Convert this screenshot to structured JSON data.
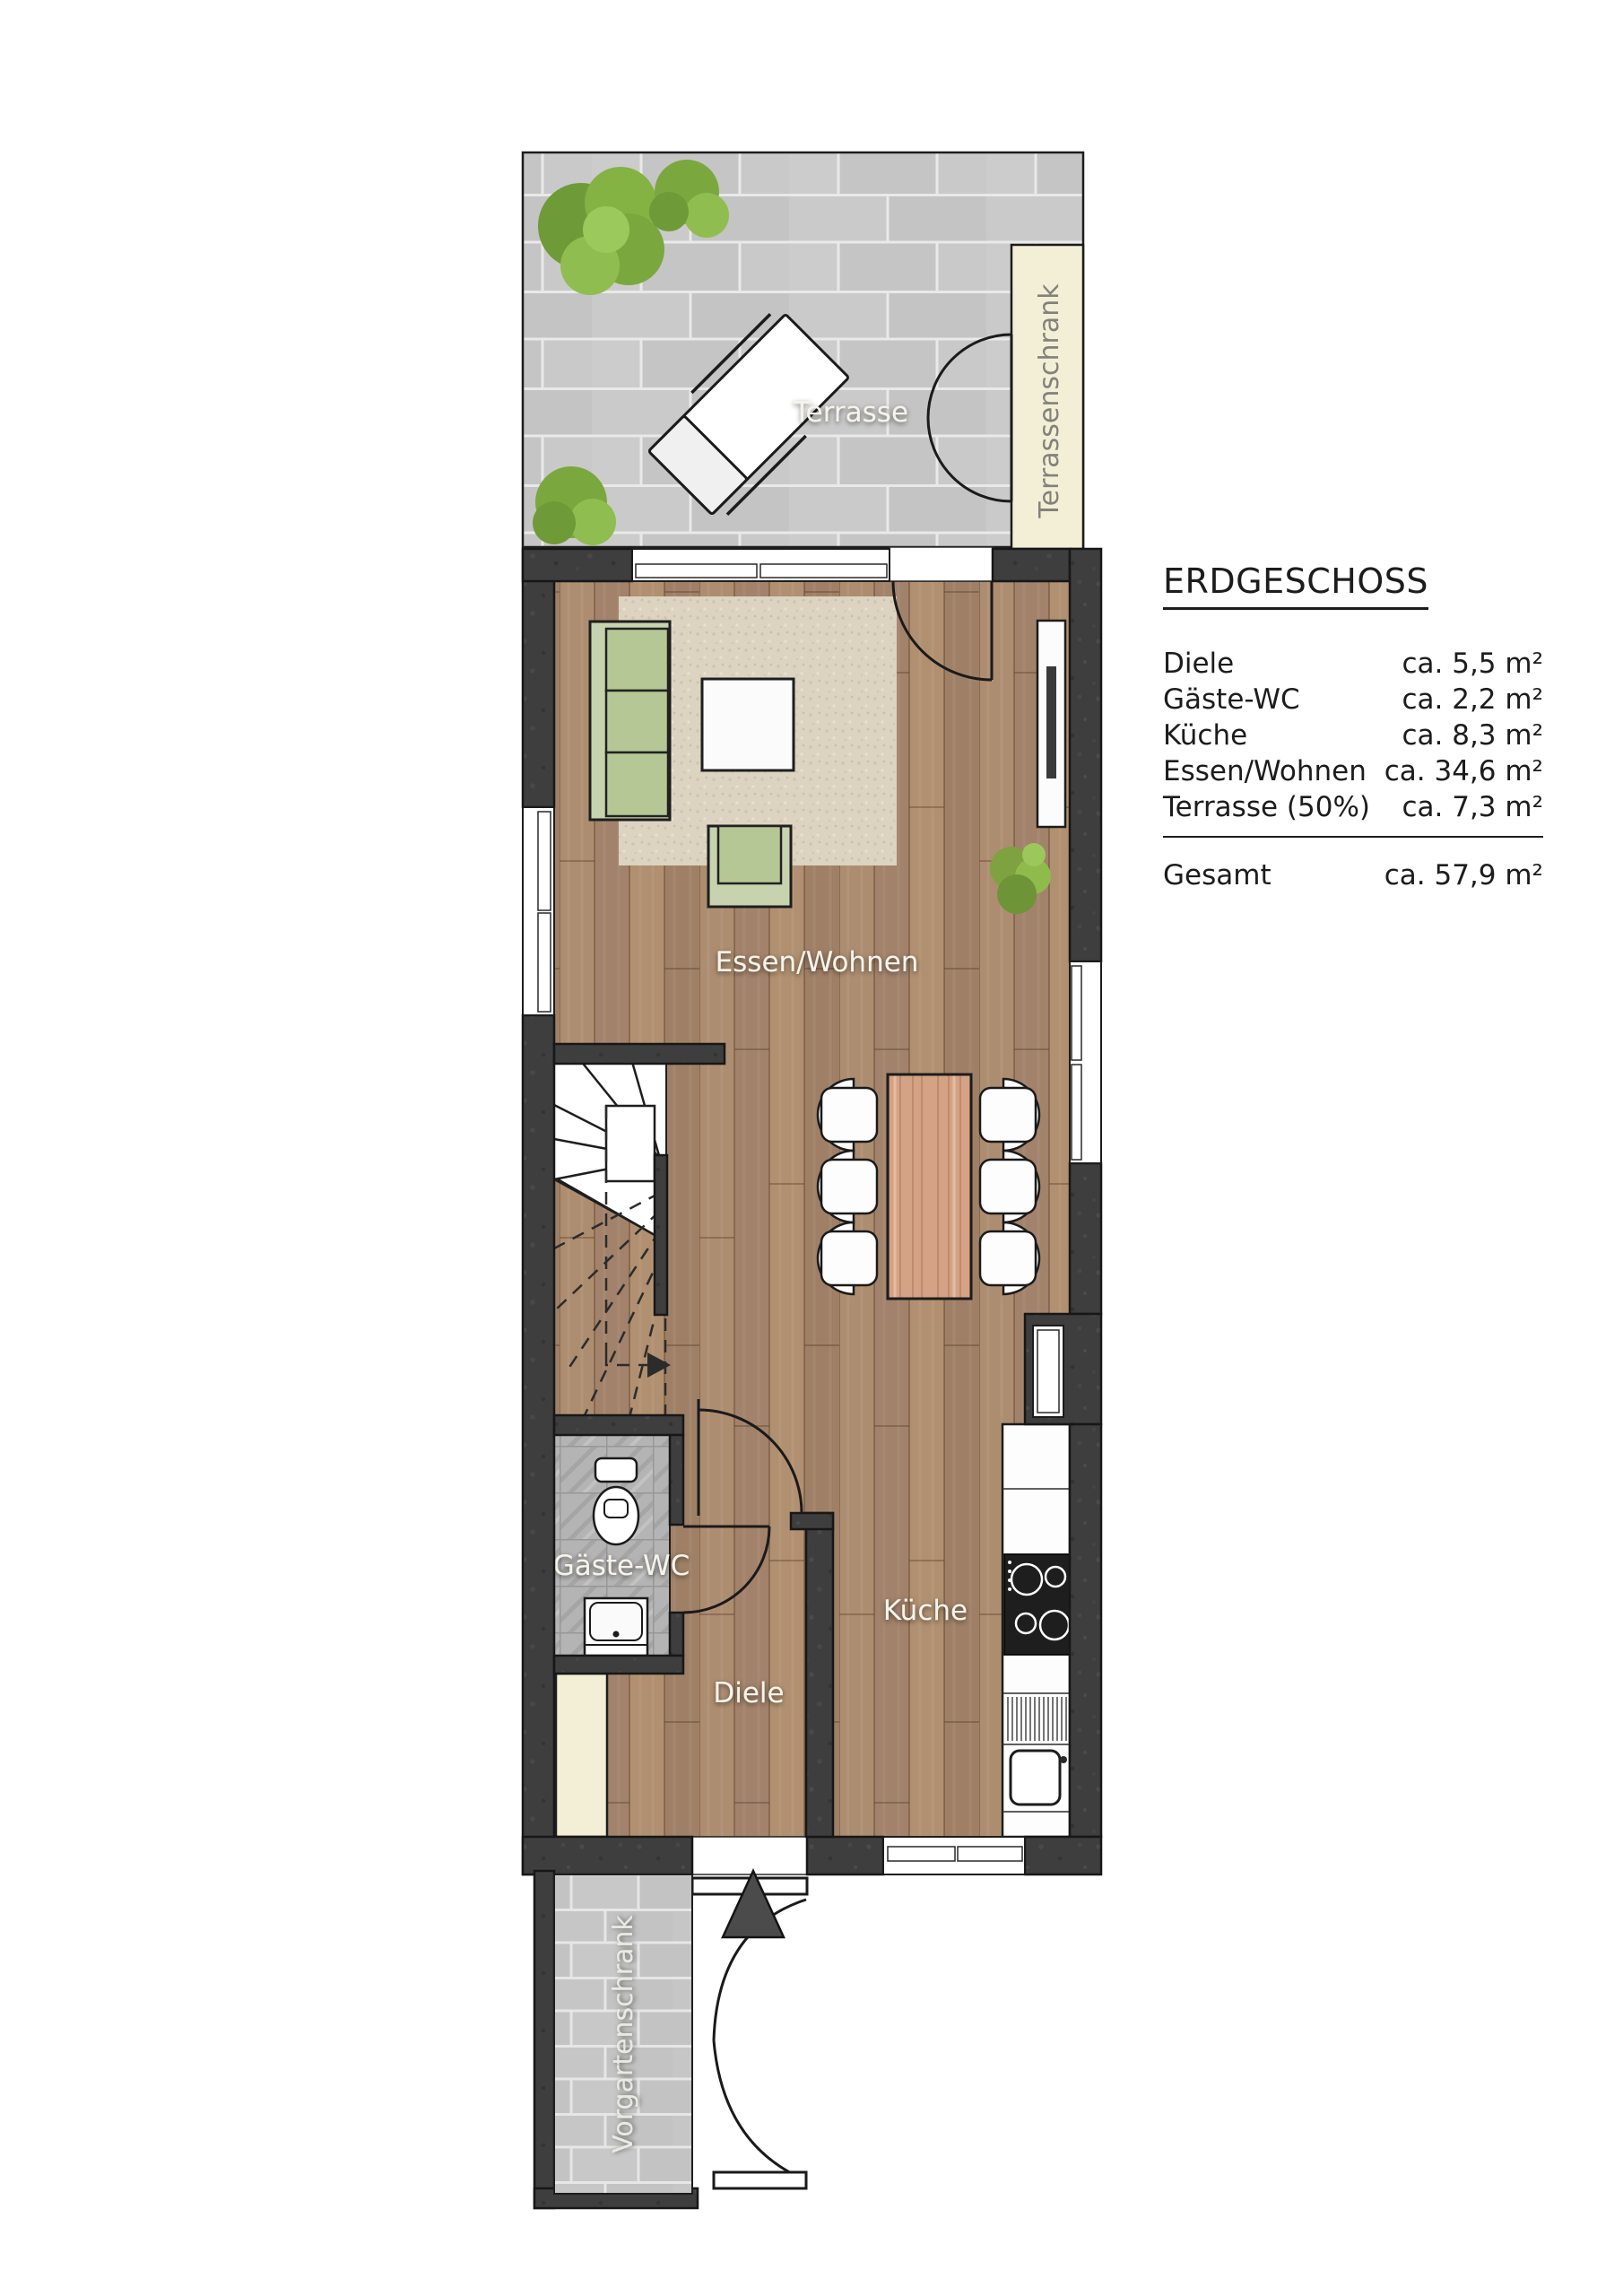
{
  "legend": {
    "title": "ERDGESCHOSS",
    "rows": [
      {
        "label": "Diele",
        "value": "ca. 5,5 m²"
      },
      {
        "label": "Gäste-WC",
        "value": "ca. 2,2 m²"
      },
      {
        "label": "Küche",
        "value": "ca. 8,3 m²"
      },
      {
        "label": "Essen/Wohnen",
        "value": "ca. 34,6 m²"
      },
      {
        "label": "Terrasse (50%)",
        "value": "ca. 7,3 m²"
      }
    ],
    "total": {
      "label": "Gesamt",
      "value": "ca. 57,9 m²"
    }
  },
  "rooms": {
    "terrasse": "Terrasse",
    "essen_wohnen": "Essen/Wohnen",
    "kueche": "Küche",
    "diele": "Diele",
    "gaeste_wc": "Gäste-WC"
  },
  "cabinets": {
    "terrassenschrank": "Terrassenschrank",
    "vorgartenschrank": "Vorgartenschrank"
  },
  "colors": {
    "wall": "#3e3e3e",
    "wood_floor": "#a6866b",
    "terrace_paving": "#c7c7c7",
    "cabinet_cream": "#f3efd7",
    "sofa_green": "#b7ca9c",
    "table_wood": "#d4a284",
    "wc_tiles": "#b4b4b4",
    "label_white": "#f6f3ea",
    "legend_text": "#1c1c1c"
  }
}
